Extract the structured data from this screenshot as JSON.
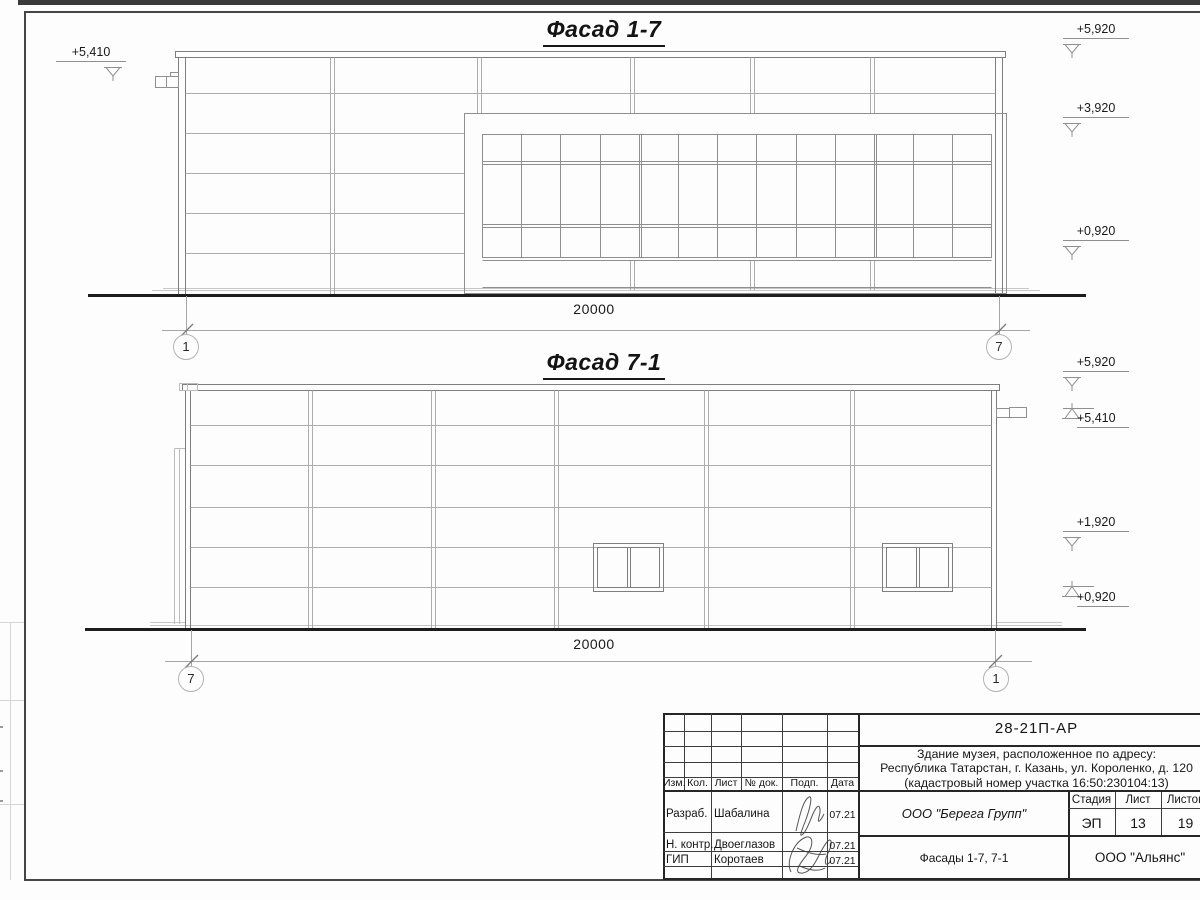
{
  "sheet": {
    "colors": {
      "paper": "#fdfdfd",
      "ink": "#1d1d1d",
      "drawing_line": "#9c9c9c"
    },
    "facades": [
      {
        "title": "Фасад 1-7",
        "dimension": "20000",
        "axis_left": "1",
        "axis_right": "7",
        "elevation_left": "+5,410",
        "elevations_right": [
          "+5,920",
          "+3,920",
          "+0,920"
        ]
      },
      {
        "title": "Фасад 7-1",
        "dimension": "20000",
        "axis_left": "7",
        "axis_right": "1",
        "elevations_right": [
          "+5,920",
          "+5,410",
          "+1,920",
          "+0,920"
        ]
      }
    ],
    "title_block": {
      "doc_number": "28-21П-АР",
      "project_description": {
        "line1": "Здание музея, расположенное по адресу:",
        "line2": "Республика Татарстан, г. Казань, ул. Короленко, д. 120",
        "line3": "(кадастровый номер участка 16:50:230104:13)"
      },
      "revision_columns": [
        "Изм.",
        "Кол.",
        "Лист",
        "№ док.",
        "Подп.",
        "Дата"
      ],
      "signature_rows": [
        {
          "role": "Разраб.",
          "name": "Шабалина",
          "date": "07.21"
        },
        {
          "role": "Н. контр.",
          "name": "Двоеглазов",
          "date": "07.21"
        },
        {
          "role": "ГИП",
          "name": "Коротаев",
          "date": "07.21"
        }
      ],
      "designer_company": "ООО \"Берега Групп\"",
      "stage_label": "Стадия",
      "sheet_label": "Лист",
      "sheets_label": "Листов",
      "stage": "ЭП",
      "sheet_number": "13",
      "sheets_total": "19",
      "sheet_title": "Фасады 1-7, 7-1",
      "client_company": "ООО \"Альянс\""
    }
  }
}
